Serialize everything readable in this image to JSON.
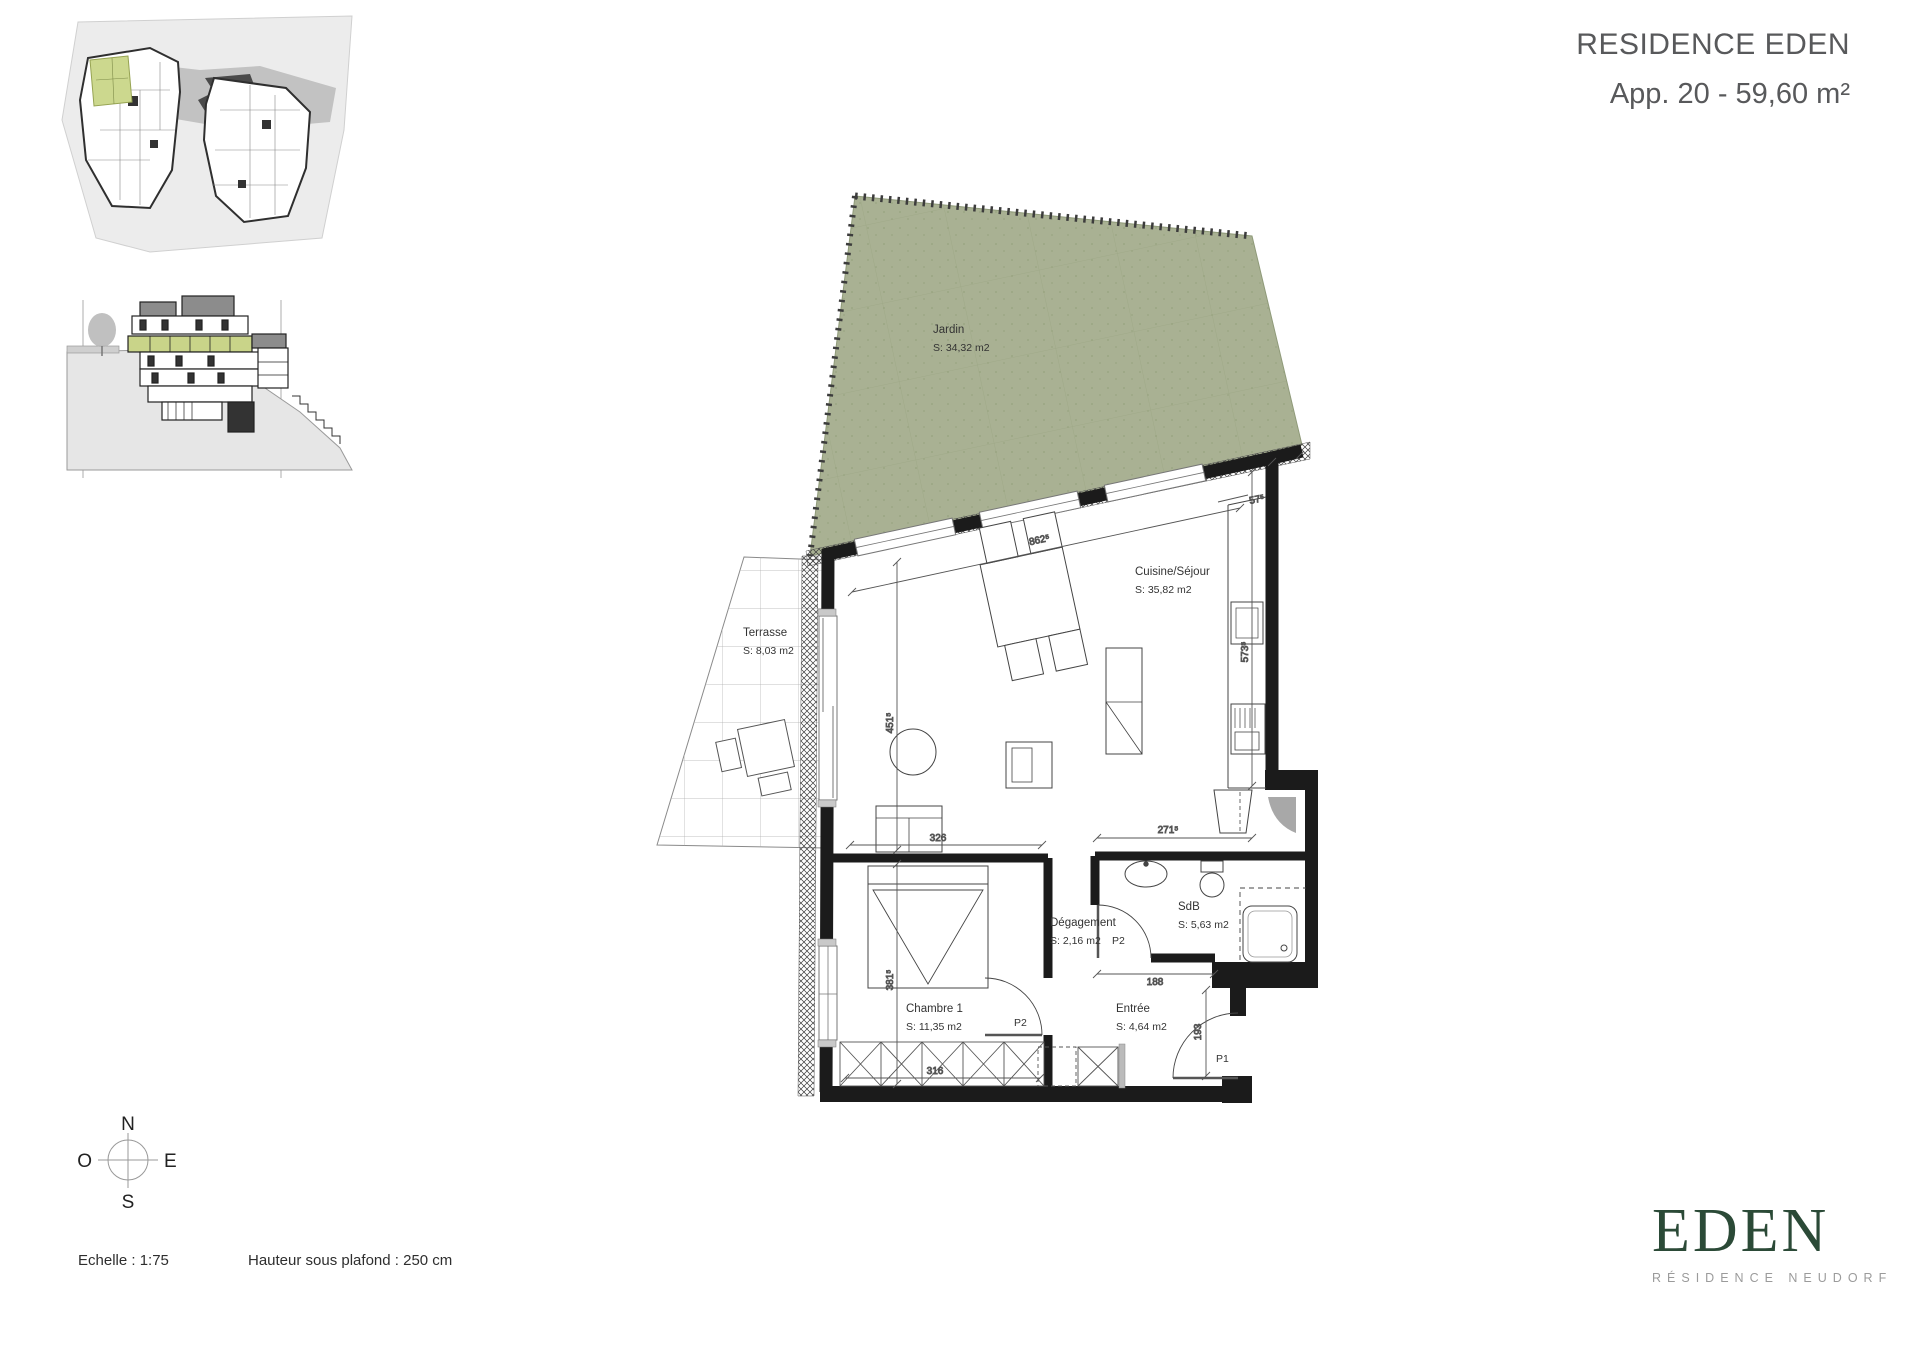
{
  "header": {
    "title": "RESIDENCE EDEN",
    "subtitle": "App. 20 - 59,60 m²"
  },
  "plan": {
    "rooms": [
      {
        "name": "Jardin",
        "area": "S: 34,32 m2"
      },
      {
        "name": "Terrasse",
        "area": "S: 8,03 m2"
      },
      {
        "name": "Cuisine/Séjour",
        "area": "S: 35,82 m2"
      },
      {
        "name": "Chambre 1",
        "area": "S: 11,35 m2"
      },
      {
        "name": "Dégagement",
        "area": "S: 2,16 m2"
      },
      {
        "name": "SdB",
        "area": "S: 5,63 m2"
      },
      {
        "name": "Entrée",
        "area": "S: 4,64 m2"
      }
    ],
    "dimensions": [
      {
        "id": "top-wall",
        "label": "862⁵"
      },
      {
        "id": "corner",
        "label": "57⁵"
      },
      {
        "id": "living-left",
        "label": "451⁵"
      },
      {
        "id": "chambre-left",
        "label": "381⁵"
      },
      {
        "id": "chambre-width",
        "label": "326"
      },
      {
        "id": "wardrobe",
        "label": "316"
      },
      {
        "id": "kitchen-right",
        "label": "573⁵"
      },
      {
        "id": "kitchen-bottom",
        "label": "271⁵"
      },
      {
        "id": "sdb-door",
        "label": "188"
      },
      {
        "id": "entree-door",
        "label": "193"
      }
    ],
    "doors": [
      {
        "id": "sdb",
        "label": "P2"
      },
      {
        "id": "chambre",
        "label": "P2"
      },
      {
        "id": "entree",
        "label": "P1"
      }
    ]
  },
  "compass": {
    "north": "N",
    "south": "S",
    "east": "E",
    "west": "O"
  },
  "footer": {
    "scale_label": "Echelle : 1:75",
    "ceiling_label": "Hauteur sous plafond : 250 cm"
  },
  "logo": {
    "wordmark": "EDEN",
    "tagline": "RÉSIDENCE NEUDORF"
  },
  "colors": {
    "garden_green": "#a9b193",
    "highlight_green": "#ccd88e",
    "section_green": "#c9d489",
    "wall_black": "#1b1b1b",
    "logo_green": "#2b4a37",
    "header_gray": "#58595b"
  }
}
